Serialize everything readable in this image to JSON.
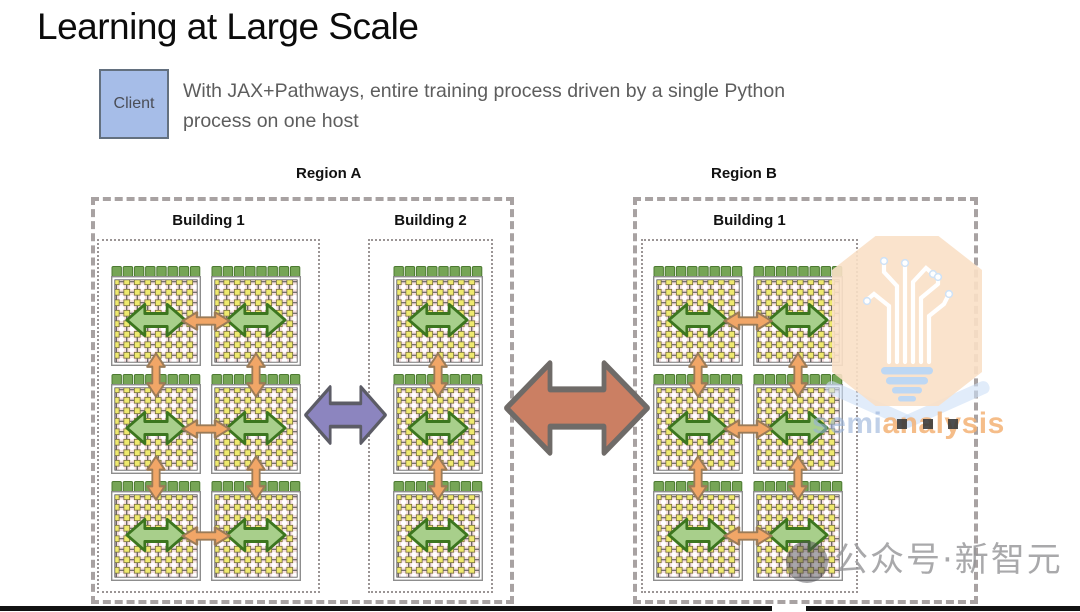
{
  "slide": {
    "title": "Learning at Large Scale",
    "client_label": "Client",
    "description_line1": "With JAX+Pathways, entire training process driven by a single Python",
    "description_line2": "process on one host"
  },
  "diagram": {
    "regions": [
      {
        "label": "Region A",
        "buildings": [
          {
            "label": "Building 1",
            "pod_grid": "2 columns x 3 rows"
          },
          {
            "label": "Building 2",
            "pod_grid": "1 column x 3 rows"
          }
        ]
      },
      {
        "label": "Region B",
        "buildings": [
          {
            "label": "Building 1",
            "pod_grid": "2 columns x 3 rows"
          }
        ]
      }
    ],
    "colors": {
      "client_box_blue": "#a6bde8",
      "pod_cap_green": "#76a556",
      "pod_mesh_yellow": "#efe96f",
      "pod_mesh_pink": "#f7dfe0",
      "intra_pod_arrow_green": "#a8cf8b",
      "inter_pod_arrow_orange": "#f1a667",
      "inter_building_arrow_purple": "#8c85bf",
      "inter_region_arrow_salmon": "#cb7f63"
    }
  },
  "watermark": {
    "brand_semi": "semi",
    "brand_analysis": "analysis",
    "wechat_text": "公众号·新智元"
  }
}
